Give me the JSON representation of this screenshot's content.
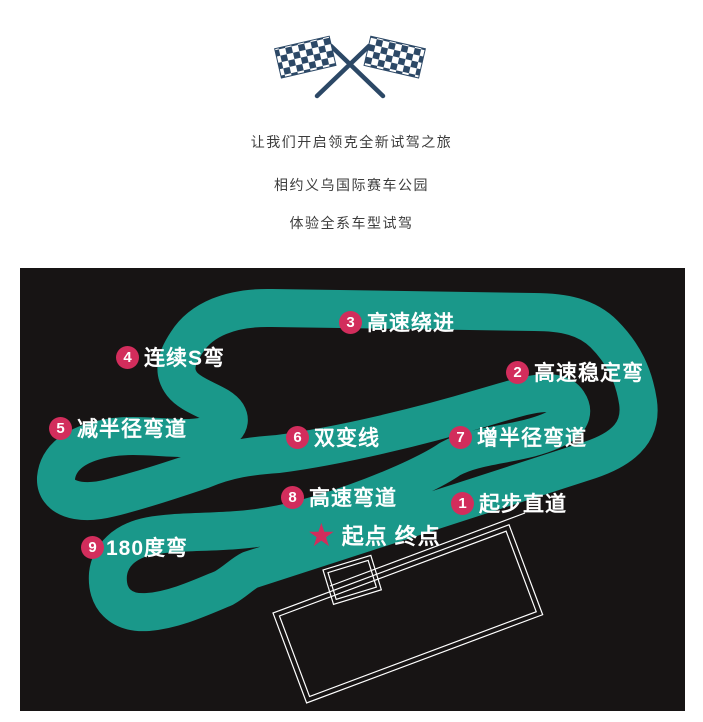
{
  "header": {
    "icon": "crossed-checkered-flags-icon",
    "lines": [
      "让我们开启领克全新试驾之旅",
      "相约义乌国际赛车公园",
      "体验全系车型试驾"
    ]
  },
  "track_map": {
    "colors": {
      "panel_background": "#171414",
      "track": "#1a988a",
      "badge": "#d22d5c",
      "label_text": "#ffffff",
      "building_outline": "#ffffff",
      "flag_navy": "#2c4866",
      "intro_text": "#3c3c3c"
    },
    "start": {
      "marker": "star",
      "label": "起点 终点"
    },
    "corners": [
      {
        "num": "1",
        "label": "起步直道"
      },
      {
        "num": "2",
        "label": "高速稳定弯"
      },
      {
        "num": "3",
        "label": "高速绕进"
      },
      {
        "num": "4",
        "label": "连续S弯"
      },
      {
        "num": "5",
        "label": "减半径弯道"
      },
      {
        "num": "6",
        "label": "双变线"
      },
      {
        "num": "7",
        "label": "增半径弯道"
      },
      {
        "num": "8",
        "label": "高速弯道"
      },
      {
        "num": "9",
        "label": "180度弯"
      }
    ]
  }
}
